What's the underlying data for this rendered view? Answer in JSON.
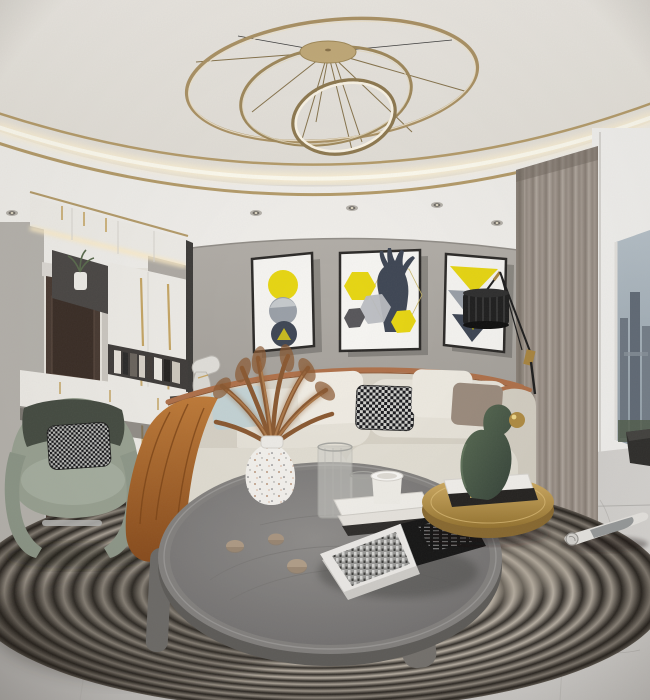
{
  "meta": {
    "title": "Modern living room interior - panoramic 3D render",
    "type": "photorealistic interior visualization, no visible readable text",
    "style": "contemporary gray / cream / brass with yellow art accents"
  },
  "palette": {
    "ceiling": "#e9e6df",
    "gold": "#b59c6a",
    "cove_glow": "#fff3d6",
    "wall": "#aca8a2",
    "cabinet": "#f0eee9",
    "handle_gold": "#c7a765",
    "door": "#483a32",
    "mirror": "#cdc9c2",
    "art_yellow": "#e8d711",
    "art_gray": "#9aa0a8",
    "art_navy": "#3e4654",
    "frame_black": "#2b2927",
    "curtain": "#9b928a",
    "window_frame": "#f4f3f0",
    "sky": "#aab7c0",
    "city": "#717b87",
    "sofa": "#e0dbcf",
    "leather": "#b0714a",
    "throw": "#b4702e",
    "pillow_blue": "#c5d4d6",
    "pillow_taupe": "#9c8c7e",
    "chair": "#9aa393",
    "chair_dark": "#454c42",
    "rug_dark": "#332f2a",
    "rug_light": "#c6bdb0",
    "floor": "#c8c6c3",
    "table_wood": "#82807e",
    "table_leg": "#6e6c69",
    "gold_metal": "#b08c42",
    "sculpture": "#46564a",
    "lamp": "#1e1e1e",
    "stone": "#b09c86",
    "pampas": "#935f33",
    "book_black": "#151515",
    "page_white": "#efedea"
  },
  "scene": {
    "objects": [
      {
        "name": "ceiling-cove",
        "desc": "curved stepped ceiling cove with warm LED strip and brass trim lines, recessed spotlights"
      },
      {
        "name": "ring-chandelier",
        "desc": "brass chandelier of three interlocking rings with thin spokes on a round canopy"
      },
      {
        "name": "fabric-wall",
        "desc": "gray linen feature wall behind sofa"
      },
      {
        "name": "artwork-circles",
        "desc": "framed print: yellow, marble-gray and navy circles stacked"
      },
      {
        "name": "artwork-deer",
        "desc": "framed print: navy deer bust with yellow and gray hexagons"
      },
      {
        "name": "artwork-triangles",
        "desc": "framed print: yellow, gray and navy inverted triangles"
      },
      {
        "name": "entry-door",
        "desc": "dark walnut paneled entry door in left hallway"
      },
      {
        "name": "mirror-panel",
        "desc": "mirror strip with warm brass reflections beside door"
      },
      {
        "name": "wardrobe-unit",
        "desc": "white floor-to-ceiling cabinets with long brass pulls, dark display niches, shelf with books and small plant vase"
      },
      {
        "name": "table-lamp-figurine",
        "desc": "small white spotlight-style lamp on slim console behind sofa arm"
      },
      {
        "name": "curtains",
        "desc": "taupe floor length curtains on right wall"
      },
      {
        "name": "balcony-opening",
        "desc": "white framed opening with city skyline view and dark doormat"
      },
      {
        "name": "floor-lamp",
        "desc": "black ribbed drum shade on angled black and brass truss arm"
      },
      {
        "name": "sofa",
        "desc": "cream modular sofa with caramel leather piping, white, blue, houndstooth and taupe pillows, caramel throw over left arm"
      },
      {
        "name": "accent-chair",
        "desc": "sage green sculptural armchair with houndstooth cushion"
      },
      {
        "name": "coffee-table",
        "desc": "large round gray wood tray-edge coffee table on curved legs"
      },
      {
        "name": "pampas-vase",
        "desc": "white speckled vase with dried brown pampas grass"
      },
      {
        "name": "glass-vases",
        "desc": "two ribbed clear glass vessels"
      },
      {
        "name": "cup-on-books",
        "desc": "white cup on stack of white and dark books"
      },
      {
        "name": "stones",
        "desc": "three small tan pebbles on tabletop"
      },
      {
        "name": "open-book",
        "desc": "open book, left page black and white city photo, right page black with white text"
      },
      {
        "name": "gold-side-table",
        "desc": "round brass tray table with white and black books"
      },
      {
        "name": "green-sculpture",
        "desc": "dark green abstract figure blowing a gold ball"
      },
      {
        "name": "rolled-magazine",
        "desc": "rolled magazine lying on rug at right"
      },
      {
        "name": "round-rug",
        "desc": "large round rug of fine concentric dark and cream stripes"
      },
      {
        "name": "marble-floor",
        "desc": "light gray marble tile floor"
      }
    ]
  }
}
